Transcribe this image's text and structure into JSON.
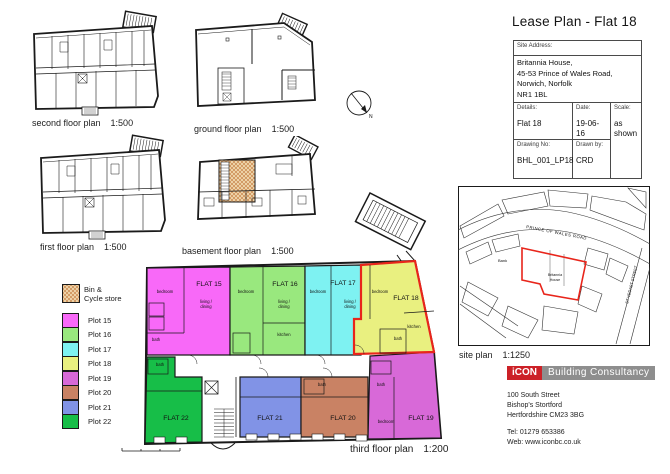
{
  "page_title": "Lease Plan - Flat 18",
  "colors": {
    "highlight_red": "#E8251B",
    "logo_red": "#CC2127",
    "logo_gray": "#8E8E8E",
    "bin_fill": "#F2DCB3",
    "bin_hatch": "#C8854B"
  },
  "plans": {
    "second": {
      "caption": "second floor plan",
      "scale": "1:500"
    },
    "ground": {
      "caption": "ground floor plan",
      "scale": "1:500"
    },
    "first": {
      "caption": "first floor plan",
      "scale": "1:500"
    },
    "basement": {
      "caption": "basement floor plan",
      "scale": "1:500"
    },
    "third": {
      "caption": "third floor plan",
      "scale": "1:200"
    },
    "site": {
      "caption": "site plan",
      "scale": "1:1250"
    }
  },
  "legend": {
    "bin_label_line1": "Bin &",
    "bin_label_line2": "Cycle store",
    "plots": [
      {
        "label": "Plot 15",
        "flat": "FLAT 15",
        "color": "#F869F8"
      },
      {
        "label": "Plot 16",
        "flat": "FLAT 16",
        "color": "#99E87E"
      },
      {
        "label": "Plot 17",
        "flat": "FLAT 17",
        "color": "#7EF2F2"
      },
      {
        "label": "Plot 18",
        "flat": "FLAT 18",
        "color": "#E9F080"
      },
      {
        "label": "Plot 19",
        "flat": "FLAT 19",
        "color": "#D869D8"
      },
      {
        "label": "Plot 20",
        "flat": "FLAT 20",
        "color": "#C98264"
      },
      {
        "label": "Plot 21",
        "flat": "FLAT 21",
        "color": "#8193E6"
      },
      {
        "label": "Plot 22",
        "flat": "FLAT 22",
        "color": "#17BE48"
      }
    ]
  },
  "room_labels": {
    "bedroom": "bedroom",
    "living1": "living /",
    "living2": "dining",
    "kitchen": "kitchen",
    "bath": "bath"
  },
  "site_plan": {
    "road": "PRINCE OF WALES ROAD",
    "street": "ST VEDAST STREET",
    "bank": "Bank",
    "site_line1": "Britannia",
    "site_line2": "House"
  },
  "title_block": {
    "site_address_label": "Site Address:",
    "address": [
      "Britannia House,",
      "45-53 Prince of Wales Road,",
      "Norwich, Norfolk",
      "NR1 1BL"
    ],
    "details_label": "Details:",
    "details_value": "Flat 18",
    "date_label": "Date:",
    "date_value": "19-06-16",
    "scale_label": "Scale:",
    "scale_value": "as shown",
    "drawing_no_label": "Drawing No:",
    "drawing_no_value": "BHL_001_LP18",
    "drawn_by_label": "Drawn by:",
    "drawn_by_value": "CRD"
  },
  "branding": {
    "logo_icon": "iCON",
    "logo_text": "Building Consultancy",
    "address": [
      "100 South Street",
      "Bishop's Stortford",
      "Hertfordshire CM23 3BG"
    ],
    "tel": "Tel: 01279 653386",
    "web": "Web: www.iconbc.co.uk"
  }
}
